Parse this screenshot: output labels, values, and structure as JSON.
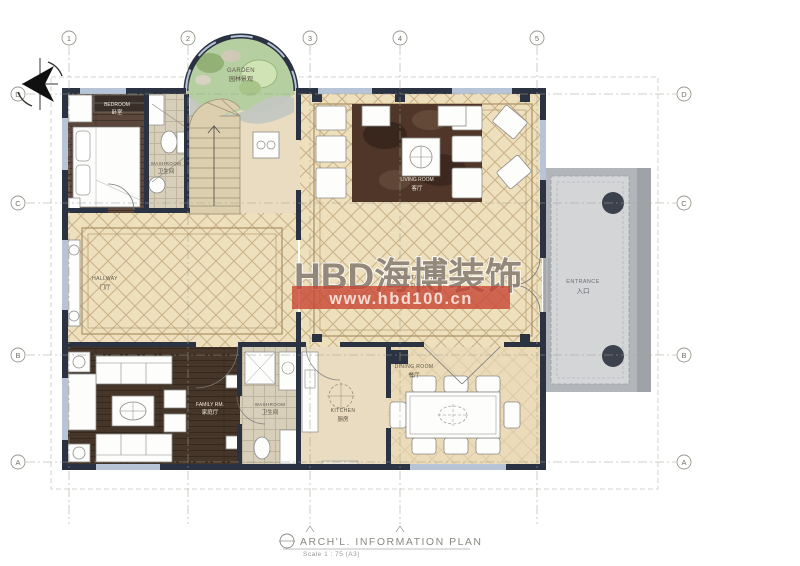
{
  "sheet": {
    "title": "ARCH'L. INFORMATION PLAN",
    "scale": "Scale 1 : 75 (A3)"
  },
  "watermark": {
    "logo": "HBD海博装饰",
    "url": "www.hbd100.cn",
    "band_color": "#c8432f",
    "logo_color": "#8e8276"
  },
  "grid": {
    "columns": [
      "1",
      "2",
      "3",
      "4",
      "5"
    ],
    "rows": [
      "D",
      "C",
      "B",
      "A"
    ]
  },
  "rooms": {
    "garden": {
      "name": "GARDEN",
      "cn": "园林景观"
    },
    "bedroom": {
      "name": "BEDROOM",
      "cn": "卧室"
    },
    "washroom_top": {
      "name": "WASHROOM",
      "cn": "卫生间"
    },
    "living": {
      "name": "LIVING ROOM",
      "cn": "客厅"
    },
    "central_hall": {
      "name": "CENTRAL HALL",
      "cn": "中央大厅"
    },
    "hallway": {
      "name": "HALLWAY",
      "cn": "门厅"
    },
    "family": {
      "name": "FAMILY RM.",
      "cn": "家庭厅"
    },
    "washroom_bottom": {
      "name": "WASHROOM",
      "cn": "卫生间"
    },
    "kitchen": {
      "name": "KITCHEN",
      "cn": "厨房"
    },
    "dining": {
      "name": "DINING ROOM",
      "cn": "餐厅"
    },
    "entrance": {
      "name": "ENTRANCE",
      "cn": "入口"
    }
  },
  "colors": {
    "wall": "#2b3342",
    "tile_floor": "#eee0bd",
    "tile_line": "#c9b189",
    "wood_bedroom": "#5a463a",
    "wood_family": "#463629",
    "rug": "#4f3629",
    "washroom_floor": "#d7cfba",
    "garden_green": "#b6cfa0",
    "porch_outer": "#b2b5b9",
    "porch_inner": "#d3d5d7",
    "grid_line": "#9aa08d"
  }
}
